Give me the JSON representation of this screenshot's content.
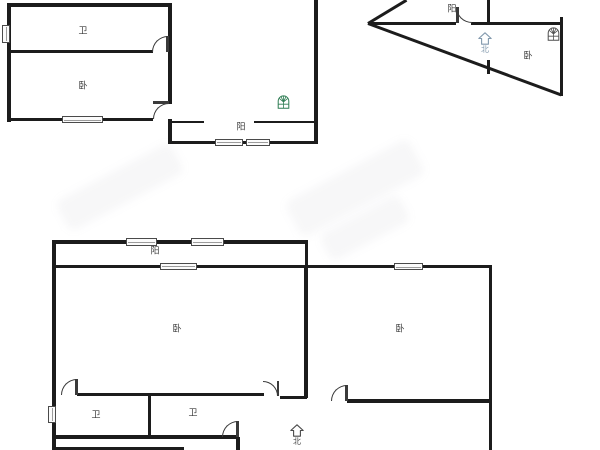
{
  "image_kind": "apartment-floor-plan",
  "colors": {
    "background": "#ffffff",
    "wall": "#1c1c1c",
    "line": "#3a3a3a",
    "window_border": "#4a4a4a",
    "label_text": "#3a3a3a",
    "logo_green": "#2f7d54",
    "logo_gray": "#4f4f4f",
    "compass_blue": "#8299ad",
    "compass_dark": "#4a4a4a"
  },
  "plans": {
    "upper_left": {
      "room_labels": [
        {
          "text": "卫"
        },
        {
          "text": "卧"
        },
        {
          "text": "阳"
        }
      ]
    },
    "upper_right": {
      "room_labels": [
        {
          "text": "阳"
        },
        {
          "text": "卧"
        }
      ],
      "compass": "北"
    },
    "lower": {
      "room_labels": [
        {
          "text": "阳"
        },
        {
          "text": "卧"
        },
        {
          "text": "卧"
        },
        {
          "text": "卫"
        },
        {
          "text": "卫"
        }
      ],
      "compass": "北"
    }
  },
  "icons": [
    {
      "name": "house-window-logo-icon",
      "variant": "green"
    },
    {
      "name": "house-window-logo-icon",
      "variant": "gray"
    },
    {
      "name": "north-compass-icon",
      "variant": "blue"
    },
    {
      "name": "north-compass-icon",
      "variant": "dark"
    }
  ],
  "geometry": {
    "walls": [
      {
        "x": 7,
        "y": 3,
        "w": 165,
        "h": 4
      },
      {
        "x": 7,
        "y": 3,
        "w": 4,
        "h": 119
      },
      {
        "x": 7,
        "y": 50,
        "w": 146,
        "h": 3
      },
      {
        "x": 168,
        "y": 3,
        "w": 4,
        "h": 101
      },
      {
        "x": 168,
        "y": 119,
        "w": 4,
        "h": 25
      },
      {
        "x": 7,
        "y": 118,
        "w": 146,
        "h": 3
      },
      {
        "x": 168,
        "y": 140.5,
        "w": 150,
        "h": 3.5
      },
      {
        "x": 314,
        "y": 0,
        "w": 3.5,
        "h": 144
      },
      {
        "x": 172,
        "y": 120.5,
        "w": 32,
        "h": 2.5
      },
      {
        "x": 254,
        "y": 120.5,
        "w": 61,
        "h": 2.5
      },
      {
        "x": 559.5,
        "y": 17,
        "w": 3.5,
        "h": 79
      },
      {
        "x": 368,
        "y": 21.5,
        "w": 88,
        "h": 3
      },
      {
        "x": 471,
        "y": 21.5,
        "w": 90,
        "h": 3
      },
      {
        "x": 487,
        "y": 0,
        "w": 3,
        "h": 23
      },
      {
        "x": 487,
        "y": 60,
        "w": 2.5,
        "h": 14
      },
      {
        "x": 52,
        "y": 240,
        "w": 256,
        "h": 3.5
      },
      {
        "x": 304.5,
        "y": 242,
        "w": 3,
        "h": 26
      },
      {
        "x": 52,
        "y": 240,
        "w": 4,
        "h": 210
      },
      {
        "x": 52,
        "y": 264.5,
        "w": 440,
        "h": 3.5
      },
      {
        "x": 488.5,
        "y": 266,
        "w": 3.5,
        "h": 184
      },
      {
        "x": 304,
        "y": 266,
        "w": 3.5,
        "h": 132
      },
      {
        "x": 77,
        "y": 393,
        "w": 187,
        "h": 3
      },
      {
        "x": 280,
        "y": 395.5,
        "w": 27,
        "h": 3
      },
      {
        "x": 347,
        "y": 399,
        "w": 143,
        "h": 3.5
      },
      {
        "x": 148,
        "y": 395,
        "w": 3,
        "h": 42
      },
      {
        "x": 52,
        "y": 435,
        "w": 187,
        "h": 3.5
      },
      {
        "x": 236,
        "y": 437,
        "w": 3.5,
        "h": 13
      },
      {
        "x": 52,
        "y": 446.5,
        "w": 132,
        "h": 3.5
      }
    ],
    "diagonals": [
      {
        "x": 368,
        "y": 21.5,
        "len": 44.5,
        "deg": -31.2
      },
      {
        "x": 368,
        "y": 21.8,
        "len": 206,
        "deg": 20.3
      }
    ],
    "windows": [
      {
        "x": 1.5,
        "y": 25,
        "w": 8,
        "h": 18,
        "o": "v"
      },
      {
        "x": 62,
        "y": 116,
        "w": 41,
        "h": 7,
        "o": "h"
      },
      {
        "x": 215,
        "y": 138.5,
        "w": 28,
        "h": 7.5,
        "o": "h"
      },
      {
        "x": 246,
        "y": 138.5,
        "w": 24,
        "h": 7.5,
        "o": "h"
      },
      {
        "x": 126,
        "y": 237.5,
        "w": 31,
        "h": 8,
        "o": "h"
      },
      {
        "x": 191,
        "y": 237.5,
        "w": 33,
        "h": 8,
        "o": "h"
      },
      {
        "x": 160,
        "y": 262.5,
        "w": 37,
        "h": 7.5,
        "o": "h"
      },
      {
        "x": 394,
        "y": 263,
        "w": 29,
        "h": 7,
        "o": "h"
      },
      {
        "x": 48,
        "y": 406,
        "w": 8,
        "h": 17,
        "o": "v"
      }
    ],
    "doors": [
      {
        "x": 152,
        "y": 36,
        "s": 16,
        "c": "tl",
        "leaf": {
          "x": 166,
          "y": 36,
          "w": 2.5,
          "h": 16
        }
      },
      {
        "x": 153,
        "y": 103,
        "s": 16,
        "c": "tl",
        "leaf": {
          "x": 153,
          "y": 101,
          "w": 16,
          "h": 2.5
        }
      },
      {
        "x": 456,
        "y": 7,
        "s": 16,
        "c": "bl",
        "leaf": {
          "x": 456,
          "y": 7,
          "w": 2.5,
          "h": 16
        }
      },
      {
        "x": 61,
        "y": 379,
        "s": 16,
        "c": "tl",
        "leaf": {
          "x": 75,
          "y": 379,
          "w": 2.5,
          "h": 16
        }
      },
      {
        "x": 263,
        "y": 381,
        "s": 15,
        "c": "tr",
        "leaf": {
          "x": 276.5,
          "y": 381,
          "w": 2.5,
          "h": 15
        }
      },
      {
        "x": 331,
        "y": 385,
        "s": 16,
        "c": "tl",
        "leaf": {
          "x": 345,
          "y": 385,
          "w": 2.5,
          "h": 16
        }
      },
      {
        "x": 222,
        "y": 421,
        "s": 16,
        "c": "tl",
        "leaf": {
          "x": 236,
          "y": 421,
          "w": 2.5,
          "h": 16
        }
      }
    ]
  }
}
